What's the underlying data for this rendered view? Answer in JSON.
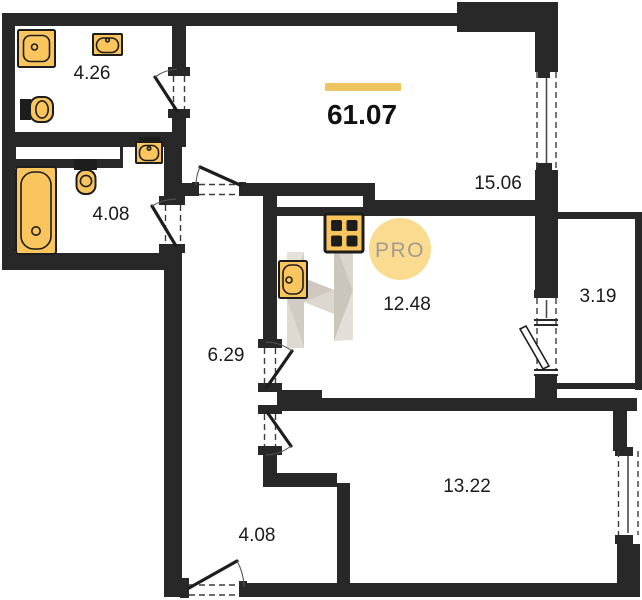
{
  "plan": {
    "total_area": "61.07",
    "rooms": {
      "bathroom_top": "4.26",
      "bathroom_lower": "4.08",
      "living": "15.06",
      "kitchen": "12.48",
      "balcony": "3.19",
      "corridor": "6.29",
      "bedroom": "13.22",
      "hallway": "4.08"
    },
    "badge": {
      "label": "PRO"
    },
    "colors": {
      "wall": "#282828",
      "fixture": "#fbc55d",
      "accent_bar": "#eec45e",
      "badge_fill": "#fadb90",
      "badge_text": "#a09c92",
      "label": "#1b1b1b",
      "watermark_light": "#dbd6cd",
      "watermark_dark": "#c6c0b5"
    },
    "icons": {
      "fixtures": [
        "washing-machine-icon",
        "sink-icon",
        "toilet-icon",
        "bathtub-icon",
        "stove-icon",
        "kitchen-sink-icon"
      ],
      "badge": "pro-badge",
      "watermark": "builder-logo-watermark"
    }
  }
}
